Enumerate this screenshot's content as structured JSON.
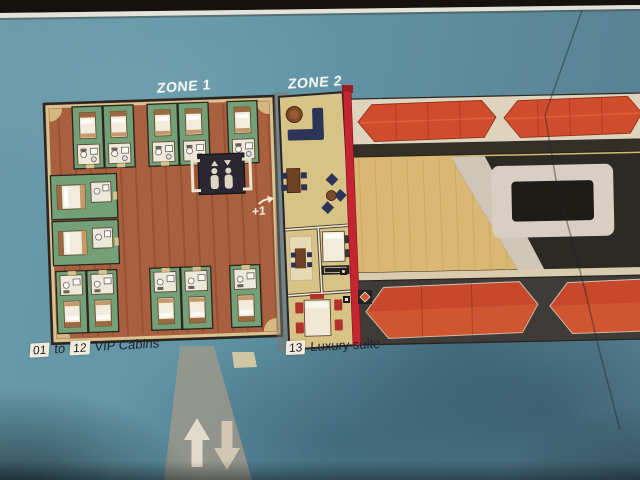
{
  "sign": {
    "zone_labels": {
      "zone1": "ZONE 1",
      "zone2": "ZONE 2"
    },
    "elevator": {
      "deck_label": "+1",
      "direction_icon": "arrow-up-right-icon"
    },
    "legend_vip": {
      "from": "01",
      "connector": "to",
      "to": "12",
      "label": "VIP Cabins"
    },
    "legend_suite": {
      "number": "13",
      "label": "Luxury suite"
    }
  },
  "icons": {
    "elevator": "elevator-people-icon",
    "stairs_up": "up-arrow-icon",
    "stairs_down": "down-arrow-icon",
    "deck_direction": "arrow-up-right-icon",
    "fire_zone_divider": "red-fire-zone-line",
    "lifeboat": "lifeboat-shape"
  },
  "colors": {
    "teal": "#6095a6",
    "red_line": "#c32531",
    "boat": "#cf4d2c",
    "boat_dark": "#c7482a",
    "cabin": "#74a077",
    "corridor": "#a9603f",
    "suite": "#d7c386",
    "navy": "#2e3458",
    "wood": "#d9b873",
    "tan": "#d9c288",
    "strip_light": "#ded4bd",
    "strip_dark": "#3f3b38",
    "label_box": "#f3ecda",
    "label_text": "#1d212e",
    "zone_text": "#f2f5f1"
  }
}
